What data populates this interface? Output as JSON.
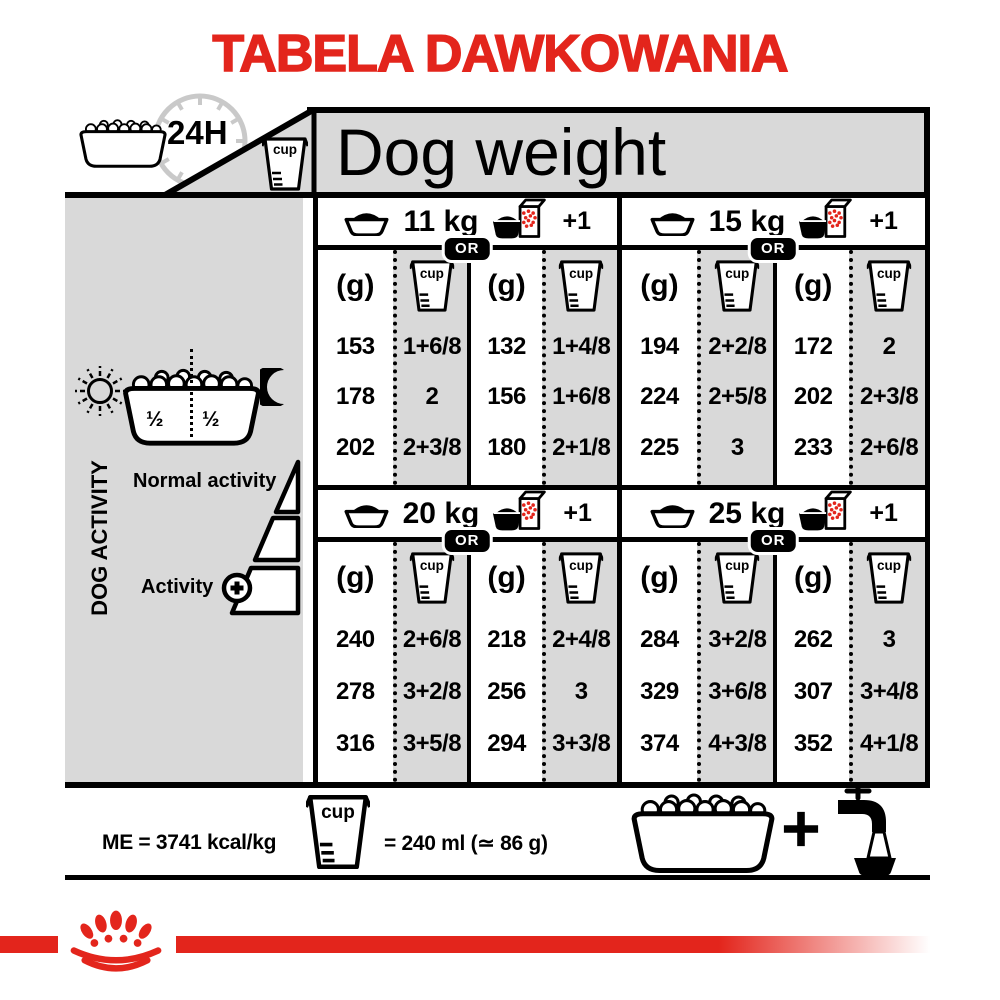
{
  "title": "TABELA DAWKOWANIA",
  "header": {
    "clock_label": "24H",
    "cup_label": "cup",
    "dog_weight": "Dog weight"
  },
  "sidebar": {
    "vertical_label": "DOG ACTIVITY",
    "half_left": "½",
    "half_right": "½",
    "normal_activity": "Normal activity",
    "activity": "Activity"
  },
  "table": {
    "or_label": "OR",
    "g_label": "(g)",
    "cup_label": "cup",
    "plus_one": "+1",
    "quadrants": [
      {
        "weight": "11 kg",
        "rows": [
          [
            "153",
            "1+6/8",
            "132",
            "1+4/8"
          ],
          [
            "178",
            "2",
            "156",
            "1+6/8"
          ],
          [
            "202",
            "2+3/8",
            "180",
            "2+1/8"
          ]
        ]
      },
      {
        "weight": "15 kg",
        "rows": [
          [
            "194",
            "2+2/8",
            "172",
            "2"
          ],
          [
            "224",
            "2+5/8",
            "202",
            "2+3/8"
          ],
          [
            "225",
            "3",
            "233",
            "2+6/8"
          ]
        ]
      },
      {
        "weight": "20 kg",
        "rows": [
          [
            "240",
            "2+6/8",
            "218",
            "2+4/8"
          ],
          [
            "278",
            "3+2/8",
            "256",
            "3"
          ],
          [
            "316",
            "3+5/8",
            "294",
            "3+3/8"
          ]
        ]
      },
      {
        "weight": "25 kg",
        "rows": [
          [
            "284",
            "3+2/8",
            "262",
            "3"
          ],
          [
            "329",
            "3+6/8",
            "307",
            "3+4/8"
          ],
          [
            "374",
            "4+3/8",
            "352",
            "4+1/8"
          ]
        ]
      }
    ]
  },
  "footer": {
    "me_text": "ME = 3741 kcal/kg",
    "cup_label": "cup",
    "cup_equiv": "= 240 ml (≃ 86 g)",
    "plus": "+"
  },
  "colors": {
    "brand_red": "#e3251c",
    "panel_gray": "#d9d9d9",
    "clock_gray": "#c9c9c9",
    "black": "#000000"
  }
}
